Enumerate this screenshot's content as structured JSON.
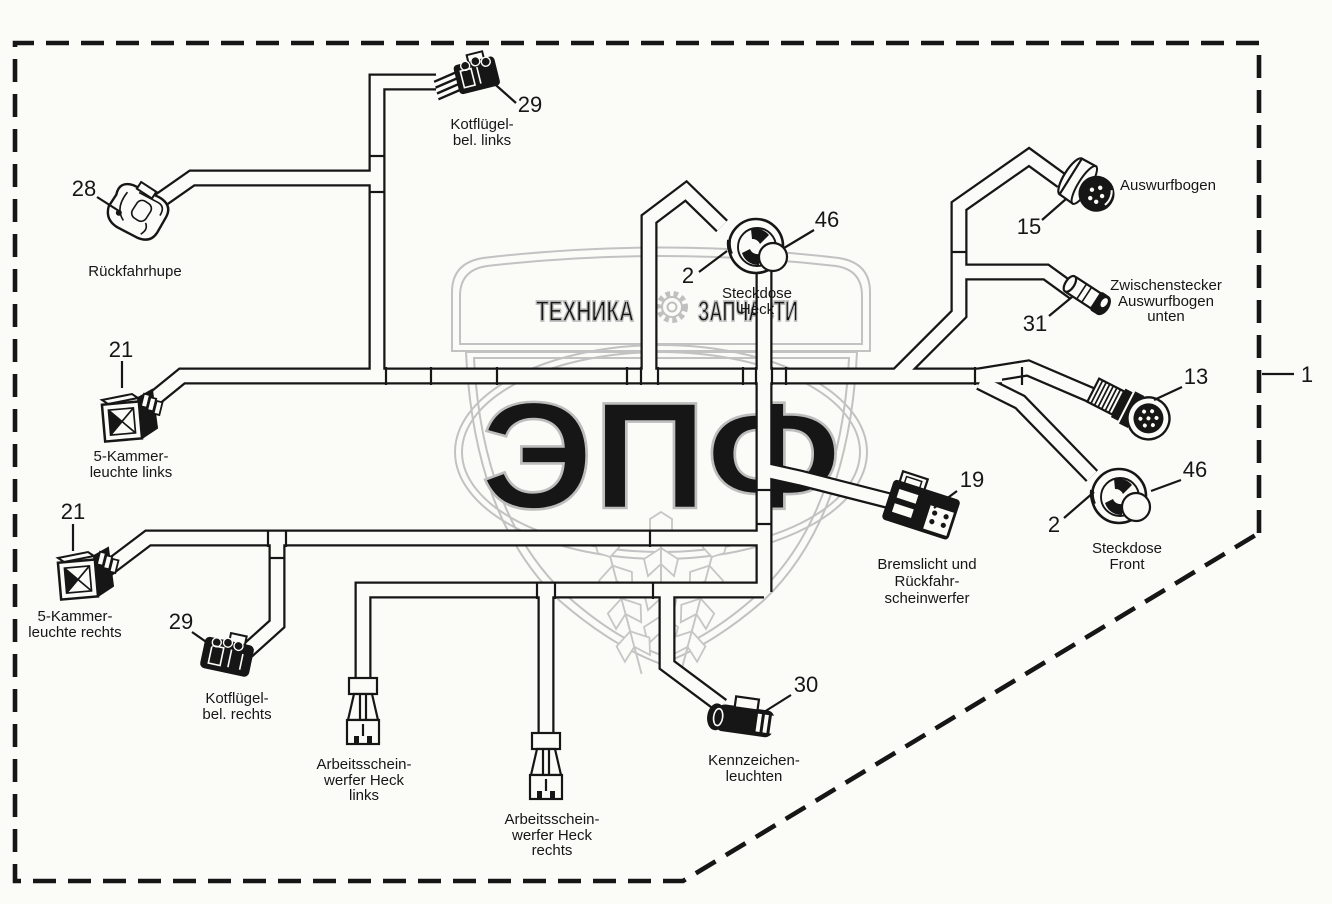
{
  "diagram": {
    "title_hint": "wiring harness parts diagram",
    "colors": {
      "ink": "#161616",
      "watermark": "#bdbdbd",
      "background": "#fbfbf8"
    },
    "frame": {
      "number": "1"
    },
    "parts": {
      "kotfluegel_links": {
        "number": "29",
        "lines": [
          "Kotflügel-",
          "bel. links"
        ]
      },
      "rueckfahrhupe": {
        "number": "28",
        "lines": [
          "Rückfahrhupe"
        ]
      },
      "kammerleuchte_links": {
        "number": "21",
        "lines": [
          "5-Kammer-",
          "leuchte links"
        ]
      },
      "steckdose_heck": {
        "number_a": "46",
        "number_b": "2",
        "lines": [
          "Steckdose",
          "Heck"
        ]
      },
      "auswurfbogen": {
        "number": "15",
        "lines": [
          "Auswurfbogen"
        ]
      },
      "zwischenstecker": {
        "number": "31",
        "lines": [
          "Zwischenstecker",
          "Auswurfbogen",
          "unten"
        ]
      },
      "rundstecker": {
        "number": "13"
      },
      "steckdose_front": {
        "number_a": "46",
        "number_b": "2",
        "lines": [
          "Steckdose",
          "Front"
        ]
      },
      "bremslicht": {
        "number": "19",
        "lines": [
          "Bremslicht und",
          "Rückfahr-",
          "scheinwerfer"
        ]
      },
      "kammerleuchte_rechts": {
        "number": "21",
        "lines": [
          "5-Kammer-",
          "leuchte rechts"
        ]
      },
      "kotfluegel_rechts": {
        "number": "29",
        "lines": [
          "Kotflügel-",
          "bel. rechts"
        ]
      },
      "arbeitsscheinwerfer_links": {
        "lines": [
          "Arbeitsschein-",
          "werfer Heck",
          "links"
        ]
      },
      "arbeitsscheinwerfer_rechts": {
        "lines": [
          "Arbeitsschein-",
          "werfer Heck",
          "rechts"
        ]
      },
      "kennzeichenleuchten": {
        "number": "30",
        "lines": [
          "Kennzeichen-",
          "leuchten"
        ]
      }
    },
    "watermark": {
      "word_left": "ТЕХНИКА",
      "word_right": "ЗАПЧАСТИ",
      "word_center": "ЭПФ"
    }
  }
}
